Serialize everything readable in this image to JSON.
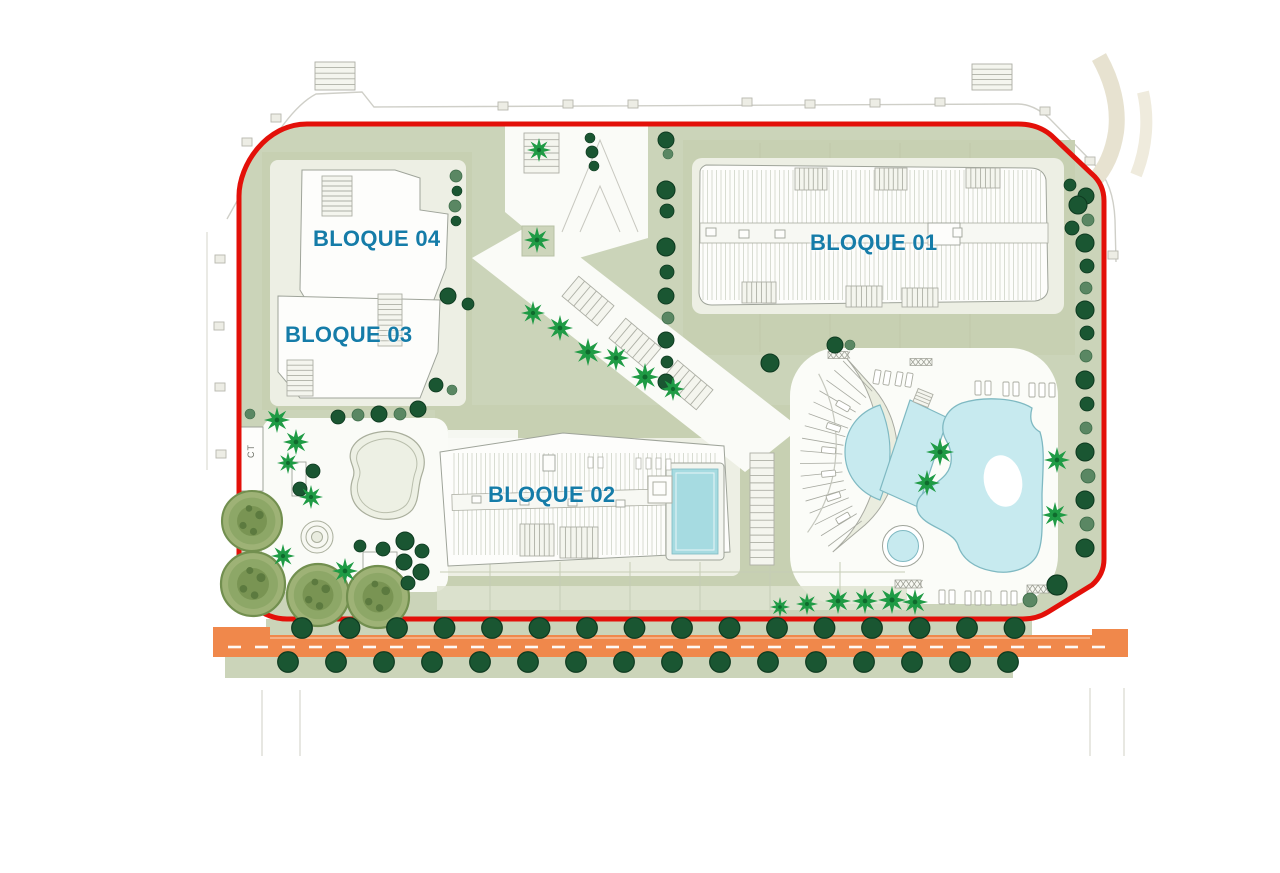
{
  "plan": {
    "labels": {
      "bloque01": "BLOQUE 01",
      "bloque02": "BLOQUE 02",
      "bloque03": "BLOQUE 03",
      "bloque04": "BLOQUE 04",
      "ct": "CT"
    },
    "colors": {
      "label_text": "#157CA8",
      "boundary_red": "#E31009",
      "road_orange": "#F0884B",
      "pool_blue": "#C7EAEF",
      "pool_edge": "#7FB9C2",
      "site_green": "#CBD4B9",
      "pad_green": "#C7D0B2",
      "tree_dark_green": "#1A5632",
      "tree_mid_green": "#5A8763",
      "palm_green": "#1F9B45",
      "big_tree_green": "#9EB276"
    }
  }
}
